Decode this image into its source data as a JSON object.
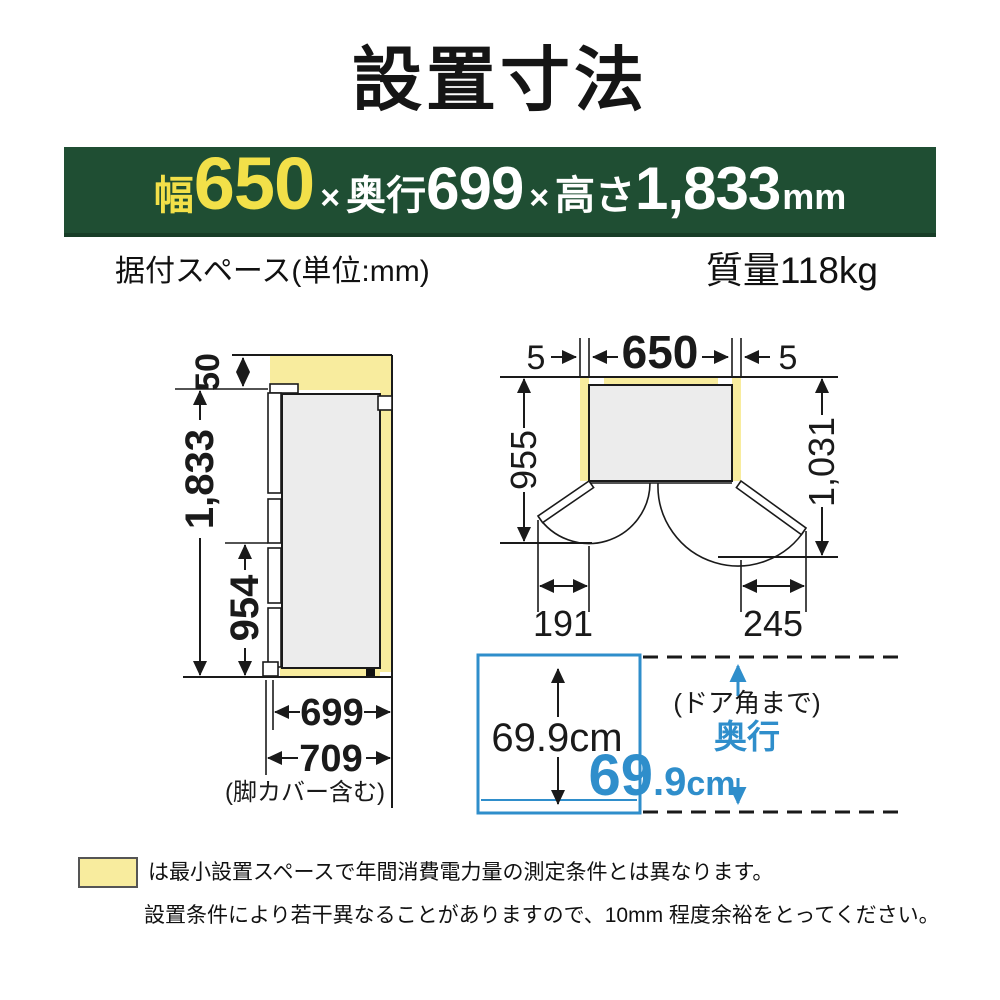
{
  "title": "設置寸法",
  "banner": {
    "width_label": "幅",
    "width_value": "650",
    "times": "×",
    "depth_label": "奥行",
    "depth_value": "699",
    "height_label": "高さ",
    "height_value": "1,833",
    "unit": "mm"
  },
  "subheader": {
    "left": "据付スペース(単位:mm)",
    "right": "質量118kg"
  },
  "side_view": {
    "top_clearance": "50",
    "total_height": "1,833",
    "lower_height": "954",
    "depth": "699",
    "depth_with_cover": "709",
    "depth_note": "(脚カバー含む)"
  },
  "top_view": {
    "left_gap": "5",
    "width": "650",
    "right_gap": "5",
    "depth_to_front": "955",
    "depth_to_door_edge": "1,031",
    "left_door_swing": "191",
    "right_door_swing": "245"
  },
  "depth_box": {
    "inner_value": "69.9cm",
    "note": "(ドア角まで)",
    "label": "奥行",
    "value_main": "69",
    "value_decimal": ".9",
    "value_unit": "cm"
  },
  "legend": {
    "line1": "は最小設置スペースで年間消費電力量の測定条件とは異なります。",
    "line2": "設置条件により若干異なることがありますので、10mm 程度余裕をとってください。"
  },
  "colors": {
    "banner_green": "#1f4e33",
    "banner_yellow": "#f2e049",
    "highlight_yellow": "#f8ec9e",
    "accent_blue": "#2f8ecb",
    "body_gray": "#ececec",
    "line_black": "#1a1a1a"
  }
}
